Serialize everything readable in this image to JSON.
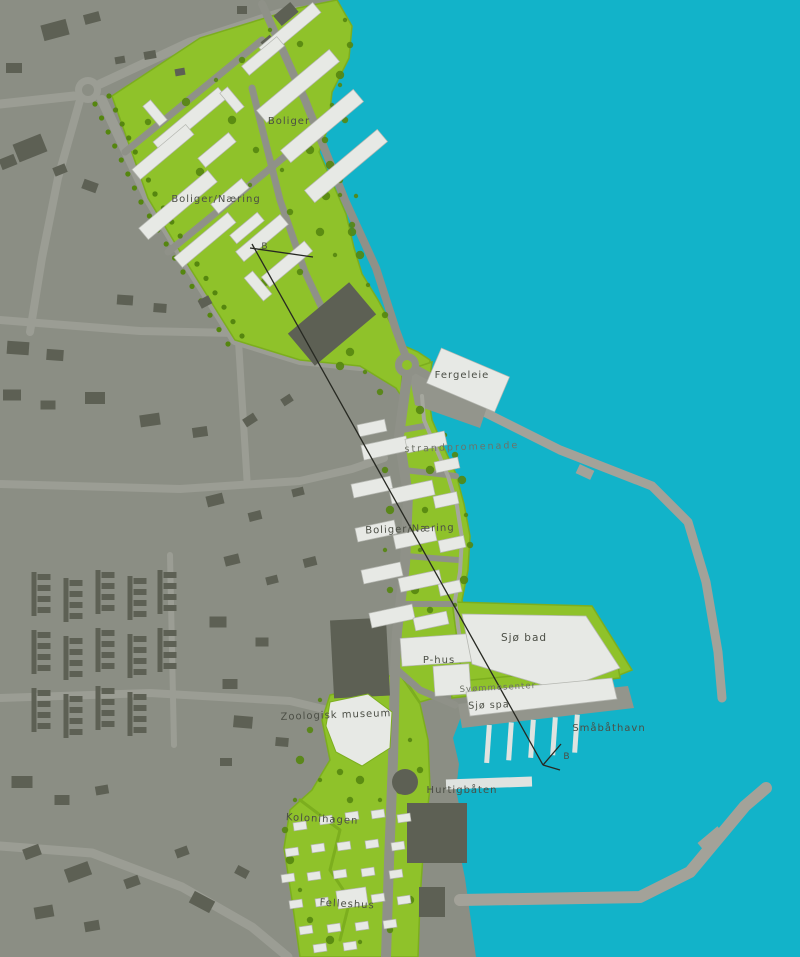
{
  "map": {
    "kind": "waterfront-urban-plan",
    "colors": {
      "water": "#12b3c9",
      "town_bg": "#8b8e84",
      "town_road": "#9b9d94",
      "district_green": "#8fc22a",
      "district_green_edge": "#7cae1e",
      "tree_green": "#55860f",
      "district_road": "#8f9188",
      "coast_road": "#a5a79e",
      "building_new": "#e7e9e5",
      "building_new_edge": "#b5b7b1",
      "building_old": "#5d6054",
      "pier": "#a3a299",
      "quay": "#93958c",
      "dock": "#dfe3e0",
      "label_text": "#4b4e45",
      "label_light": "#6e7167",
      "section_line": "#272922"
    },
    "labels": [
      {
        "id": "boliger",
        "text": "Boliger",
        "x": 289,
        "y": 124,
        "rot": 0,
        "size": 10
      },
      {
        "id": "boliger-naering-nord",
        "text": "Boliger/Næring",
        "x": 216,
        "y": 202,
        "rot": 0,
        "size": 10
      },
      {
        "id": "seksjon-b-nord",
        "text": "B",
        "x": 265,
        "y": 249,
        "rot": 0,
        "size": 9
      },
      {
        "id": "fergeleie",
        "text": "Fergeleie",
        "x": 462,
        "y": 378,
        "rot": 0,
        "size": 10
      },
      {
        "id": "strandpromenade",
        "text": "strandpromenade",
        "x": 462,
        "y": 450,
        "rot": -2,
        "size": 9.5,
        "light": true,
        "spacing": 2
      },
      {
        "id": "boliger-naering-soer",
        "text": "Boliger/Næring",
        "x": 410,
        "y": 532,
        "rot": -2,
        "size": 10
      },
      {
        "id": "sjoe-bad",
        "text": "Sjø bad",
        "x": 524,
        "y": 641,
        "rot": 0,
        "size": 10.5
      },
      {
        "id": "svoemmesenter",
        "text": "Svømmesenter",
        "x": 498,
        "y": 690,
        "rot": -3,
        "size": 8.5,
        "light": true
      },
      {
        "id": "sjoe-spa",
        "text": "Sjø spa",
        "x": 489,
        "y": 708,
        "rot": -2,
        "size": 9.5
      },
      {
        "id": "smaabaathavn",
        "text": "Småbåthavn",
        "x": 609,
        "y": 731,
        "rot": 0,
        "size": 10
      },
      {
        "id": "seksjon-b-soer",
        "text": "B",
        "x": 567,
        "y": 759,
        "rot": 0,
        "size": 9
      },
      {
        "id": "hurtigbaaten",
        "text": "Hurtigbåten",
        "x": 462,
        "y": 793,
        "rot": 0,
        "size": 10
      },
      {
        "id": "zoologisk-museum",
        "text": "Zoologisk museum",
        "x": 336,
        "y": 718,
        "rot": -2,
        "size": 10
      },
      {
        "id": "kolonihagen",
        "text": "Kolonihagen",
        "x": 322,
        "y": 822,
        "rot": 3,
        "size": 10
      },
      {
        "id": "felleshus",
        "text": "Felleshus",
        "x": 347,
        "y": 907,
        "rot": 3,
        "size": 10
      },
      {
        "id": "p-hus",
        "text": "P-hus",
        "x": 439,
        "y": 663,
        "rot": 0,
        "size": 10
      }
    ]
  }
}
